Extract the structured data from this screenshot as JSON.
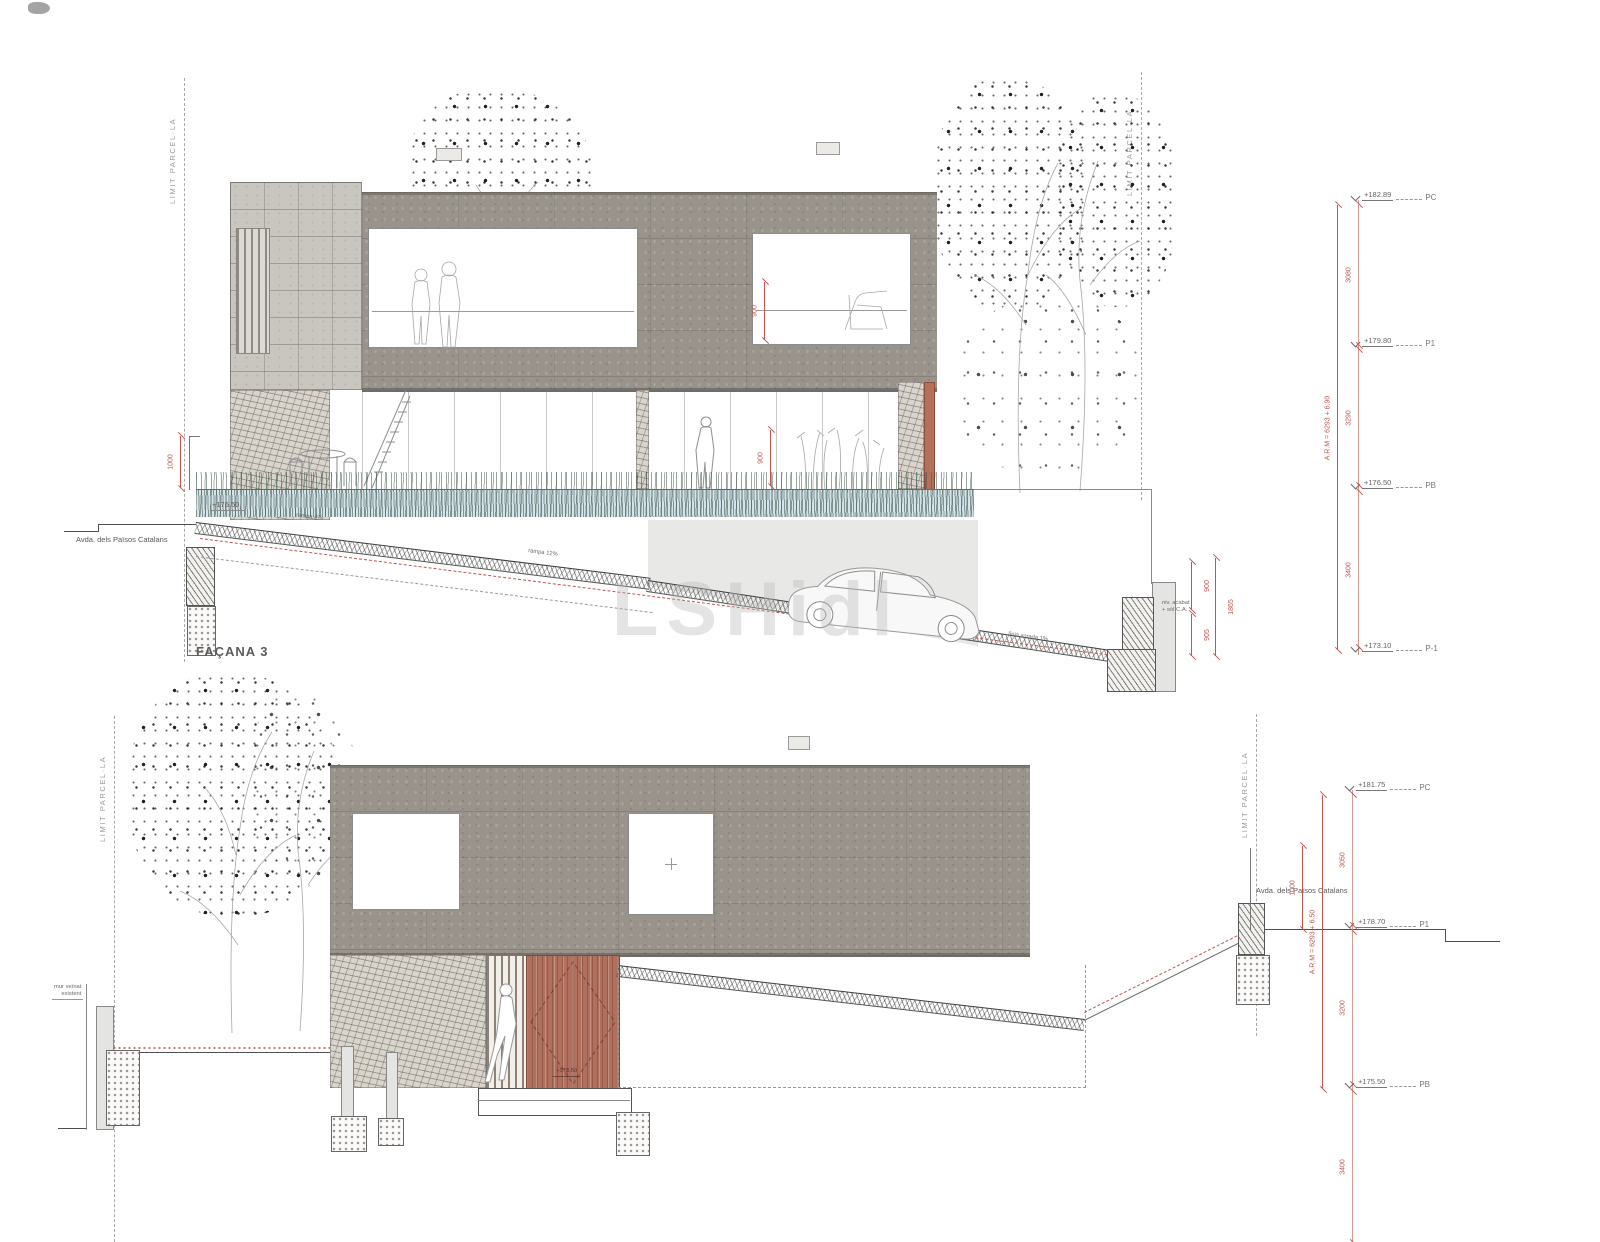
{
  "title": "FAÇANA 3",
  "watermark": "LSHidl",
  "top": {
    "limit_left": "LIMIT PARCEL·LA",
    "limit_right": "LIMIT PARCEL·LA",
    "street": {
      "name": "Avda. dels Països Catalans",
      "level": "+176.50"
    },
    "ramp_labels": {
      "upper": "rampa 4%",
      "lower": "rampa 12%",
      "edge": "línia vorada 1%"
    },
    "wall_note_line1": "niv. acabat",
    "wall_note_line2": "+ sòl C.A.",
    "dims": {
      "fence": "1000",
      "window_p1": "900",
      "window_pb": "900",
      "wall_upper": "900",
      "wall_lower": "905",
      "wall_total": "1865",
      "pc_p1": "3080",
      "p1_pb": "3290",
      "pb_p1neg": "3400",
      "overall": "A.R.M = 6293 + 6.90"
    },
    "levels": [
      {
        "value": "+182.89",
        "name": "PC"
      },
      {
        "value": "+179.80",
        "name": "P1"
      },
      {
        "value": "+176.50",
        "name": "PB"
      },
      {
        "value": "+173.10",
        "name": "P-1"
      }
    ]
  },
  "bottom": {
    "limit_left": "LIMIT PARCEL·LA",
    "limit_right": "LIMIT PARCEL·LA",
    "street": {
      "name": "Avda. dels Països Catalans",
      "level": "+178.70"
    },
    "wall_note_line1": "mur veïnat",
    "wall_note_line2": "existent",
    "gate_level": "+178.50",
    "dims": {
      "fence": "1000",
      "pc_p1": "3050",
      "p1_pb": "3200",
      "pb_lower": "3400",
      "overall": "A.R.M = 6293 + 6.50"
    },
    "levels": [
      {
        "value": "+181.75",
        "name": "PC"
      },
      {
        "value": "+178.70",
        "name": "P1"
      },
      {
        "value": "+175.50",
        "name": "PB"
      }
    ]
  }
}
